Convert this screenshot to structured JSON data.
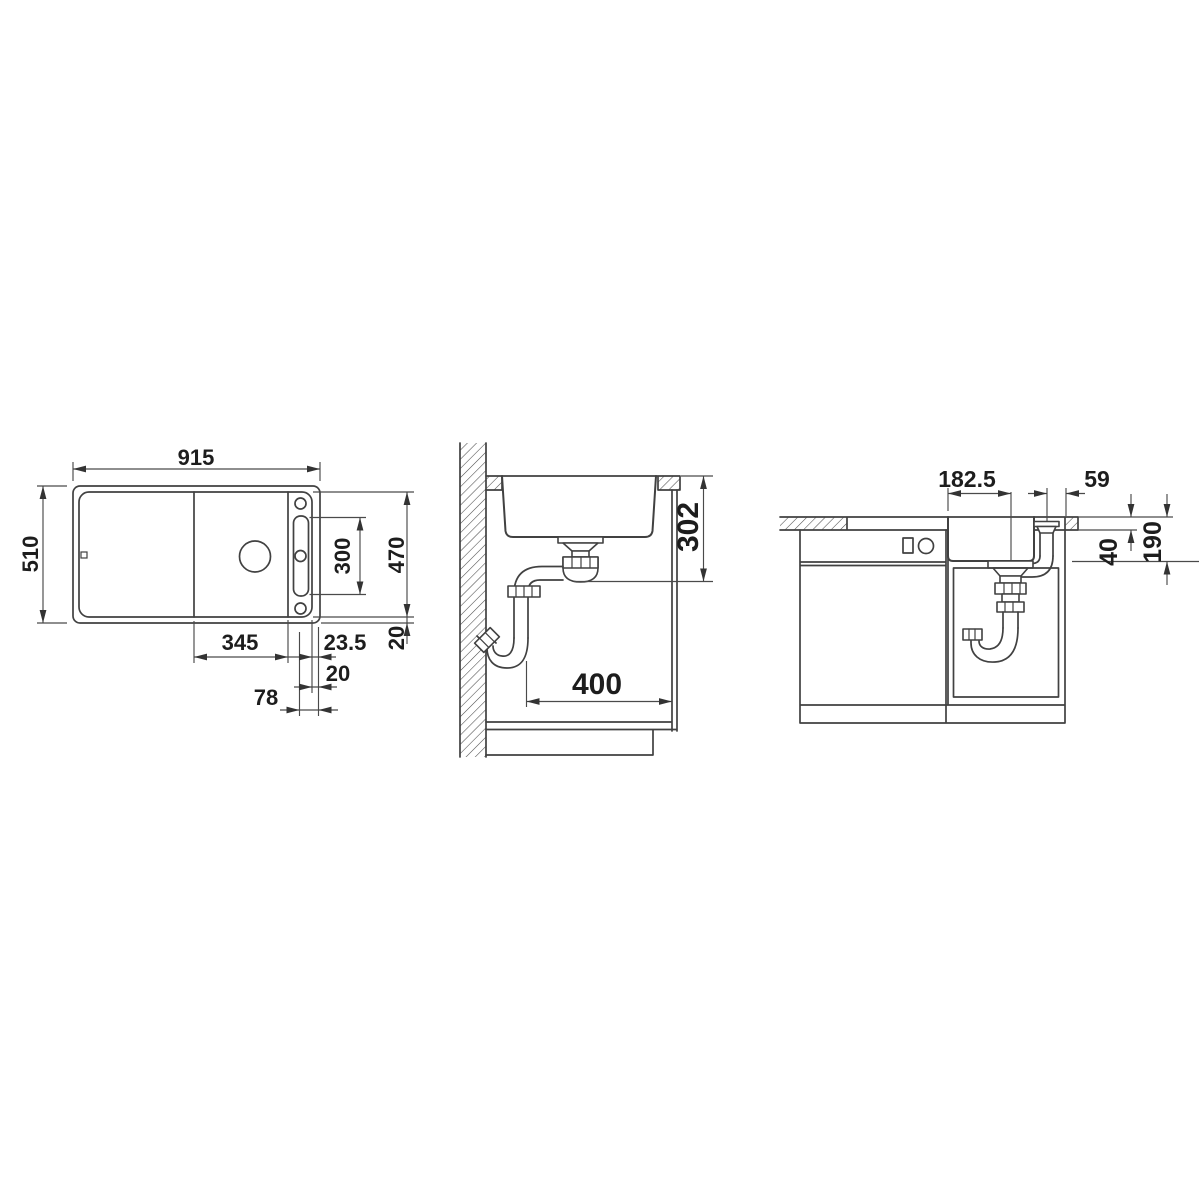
{
  "drawing": {
    "plan_view": {
      "overall_width": "915",
      "overall_depth": "510",
      "slot_length": "300",
      "inner_depth": "470",
      "rear_rim": "20",
      "bowl_width": "345",
      "edge_gap": "23.5",
      "slot_gap": "20",
      "tap_distance": "78"
    },
    "side_section": {
      "drain_depth": "302",
      "clearance": "400"
    },
    "front_section": {
      "drain_offset": "182.5",
      "pipe_offset": "59",
      "rim_height": "40",
      "outlet_height": "190"
    }
  }
}
